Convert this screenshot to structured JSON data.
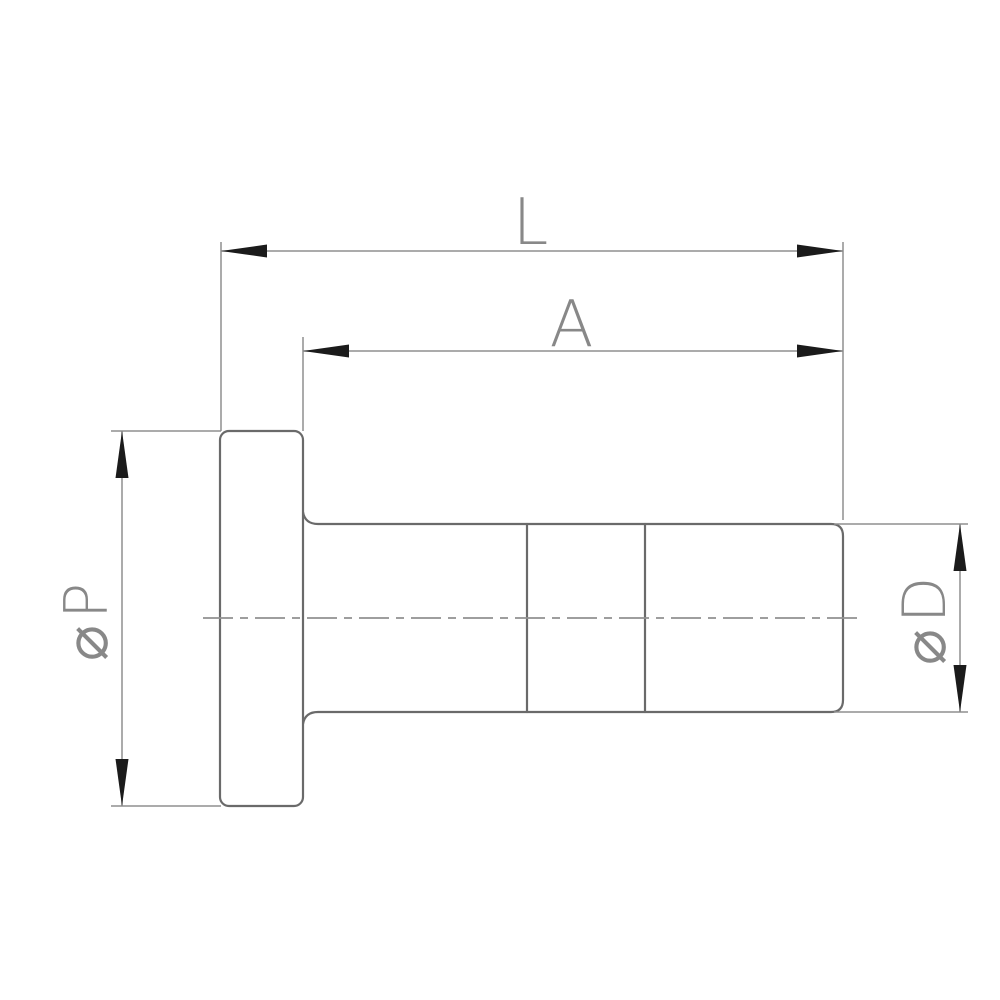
{
  "colors": {
    "background": "#ffffff",
    "part_outline": "#6a6a6a",
    "dimension_line": "#8f8f8f",
    "arrowhead": "#1b1b1b",
    "label_text": "#888888",
    "centerline": "#919191"
  },
  "dimensions": {
    "overall_length": {
      "label": "L"
    },
    "shaft_length": {
      "label": "A"
    },
    "flange_diameter": {
      "label": "⌀P"
    },
    "shaft_diameter": {
      "label": "⌀D"
    }
  }
}
